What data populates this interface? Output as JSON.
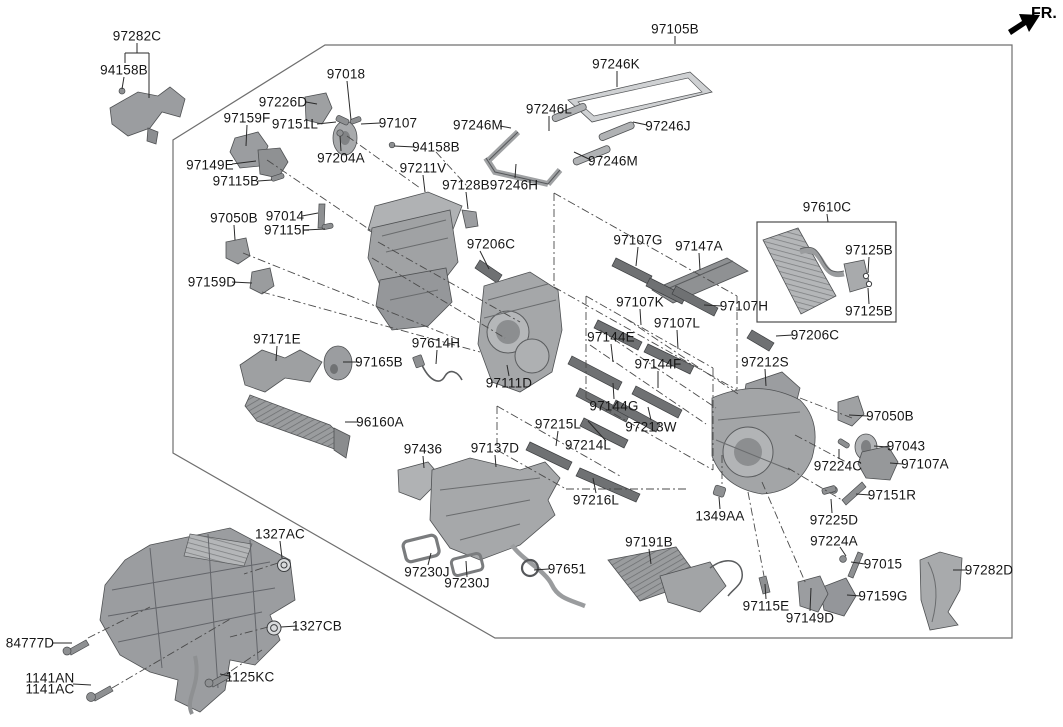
{
  "fr_indicator": {
    "label": "FR."
  },
  "canvas": {
    "width": 1063,
    "height": 727,
    "background": "#ffffff"
  },
  "styles": {
    "label_color": "#161616",
    "line_color": "#2a2a2a",
    "border_color": "#6f6f6f",
    "part_fill": "#a7a9ab",
    "part_fill_dark": "#7d8082",
    "part_fill_light": "#c9cbcd"
  },
  "labels": [
    {
      "t": "97282C",
      "x": 137,
      "y": 36,
      "l": null
    },
    {
      "t": "94158B",
      "x": 124,
      "y": 70,
      "l": [
        124,
        77,
        122,
        89
      ]
    },
    {
      "t": "97226D",
      "x": 283,
      "y": 102,
      "l": [
        306,
        102,
        317,
        104
      ]
    },
    {
      "t": "97018",
      "x": 346,
      "y": 74,
      "l": [
        347,
        81,
        351,
        120
      ]
    },
    {
      "t": "97159F",
      "x": 247,
      "y": 118,
      "l": [
        247,
        125,
        246,
        146
      ]
    },
    {
      "t": "97151L",
      "x": 295,
      "y": 124,
      "l": [
        317,
        124,
        336,
        122
      ]
    },
    {
      "t": "97107",
      "x": 398,
      "y": 123,
      "l": [
        380,
        123,
        361,
        124
      ]
    },
    {
      "t": "97204A",
      "x": 341,
      "y": 158,
      "l": [
        341,
        151,
        340,
        136
      ]
    },
    {
      "t": "94158B",
      "x": 436,
      "y": 147,
      "l": [
        415,
        147,
        394,
        146
      ]
    },
    {
      "t": "97149E",
      "x": 210,
      "y": 165,
      "l": [
        232,
        164,
        256,
        161
      ]
    },
    {
      "t": "97115B",
      "x": 236,
      "y": 181,
      "l": [
        258,
        181,
        272,
        180
      ]
    },
    {
      "t": "97211V",
      "x": 423,
      "y": 168,
      "l": [
        423,
        175,
        425,
        192
      ]
    },
    {
      "t": "97128B",
      "x": 466,
      "y": 185,
      "l": [
        466,
        192,
        468,
        209
      ]
    },
    {
      "t": "97246H",
      "x": 514,
      "y": 185,
      "l": [
        515,
        178,
        516,
        164
      ]
    },
    {
      "t": "97246M",
      "x": 478,
      "y": 125,
      "l": [
        500,
        126,
        511,
        128
      ]
    },
    {
      "t": "97246L",
      "x": 549,
      "y": 109,
      "l": [
        549,
        116,
        549,
        131
      ]
    },
    {
      "t": "97246K",
      "x": 616,
      "y": 64,
      "l": [
        617,
        71,
        617,
        87
      ]
    },
    {
      "t": "97246J",
      "x": 668,
      "y": 126,
      "l": [
        647,
        125,
        633,
        122
      ]
    },
    {
      "t": "97246M",
      "x": 613,
      "y": 161,
      "l": [
        591,
        160,
        574,
        152
      ]
    },
    {
      "t": "97105B",
      "x": 675,
      "y": 29,
      "l": [
        675,
        36,
        675,
        44
      ]
    },
    {
      "t": "97610C",
      "x": 827,
      "y": 207,
      "l": [
        827,
        214,
        828,
        222
      ]
    },
    {
      "t": "97125B",
      "x": 869,
      "y": 250,
      "l": [
        869,
        257,
        868,
        273
      ]
    },
    {
      "t": "97125B",
      "x": 869,
      "y": 311,
      "l": [
        869,
        304,
        868,
        288
      ]
    },
    {
      "t": "97206C",
      "x": 815,
      "y": 335,
      "l": [
        793,
        335,
        776,
        336
      ]
    },
    {
      "t": "97107H",
      "x": 744,
      "y": 306,
      "l": [
        722,
        306,
        704,
        305
      ]
    },
    {
      "t": "97107G",
      "x": 638,
      "y": 240,
      "l": [
        638,
        247,
        636,
        266
      ]
    },
    {
      "t": "97147A",
      "x": 699,
      "y": 246,
      "l": [
        699,
        253,
        700,
        270
      ]
    },
    {
      "t": "97107K",
      "x": 640,
      "y": 302,
      "l": [
        640,
        309,
        641,
        325
      ]
    },
    {
      "t": "97107L",
      "x": 677,
      "y": 323,
      "l": [
        677,
        330,
        678,
        349
      ]
    },
    {
      "t": "97144E",
      "x": 611,
      "y": 337,
      "l": [
        611,
        344,
        613,
        362
      ]
    },
    {
      "t": "97206C",
      "x": 491,
      "y": 244,
      "l": [
        480,
        251,
        489,
        269
      ]
    },
    {
      "t": "97212S",
      "x": 765,
      "y": 362,
      "l": [
        765,
        369,
        766,
        386
      ]
    },
    {
      "t": "97144F",
      "x": 658,
      "y": 364,
      "l": [
        658,
        371,
        658,
        388
      ]
    },
    {
      "t": "97144G",
      "x": 614,
      "y": 406,
      "l": [
        614,
        399,
        613,
        383
      ]
    },
    {
      "t": "97213W",
      "x": 651,
      "y": 427,
      "l": [
        651,
        420,
        648,
        407
      ]
    },
    {
      "t": "97215L",
      "x": 558,
      "y": 424,
      "l": [
        558,
        431,
        556,
        446
      ]
    },
    {
      "t": "97214L",
      "x": 588,
      "y": 445,
      "l": [
        606,
        441,
        588,
        421
      ]
    },
    {
      "t": "97216L",
      "x": 596,
      "y": 500,
      "l": [
        596,
        493,
        593,
        478
      ]
    },
    {
      "t": "1349AA",
      "x": 720,
      "y": 516,
      "l": [
        720,
        509,
        719,
        497
      ]
    },
    {
      "t": "97191B",
      "x": 649,
      "y": 542,
      "l": [
        649,
        549,
        651,
        564
      ]
    },
    {
      "t": "97436",
      "x": 423,
      "y": 449,
      "l": [
        423,
        456,
        424,
        468
      ]
    },
    {
      "t": "97137D",
      "x": 495,
      "y": 448,
      "l": [
        495,
        455,
        496,
        467
      ]
    },
    {
      "t": "97050B",
      "x": 234,
      "y": 218,
      "l": [
        234,
        225,
        235,
        240
      ]
    },
    {
      "t": "97014",
      "x": 285,
      "y": 216,
      "l": [
        302,
        216,
        318,
        213
      ]
    },
    {
      "t": "97115F",
      "x": 287,
      "y": 230,
      "l": [
        305,
        230,
        325,
        229
      ]
    },
    {
      "t": "97159D",
      "x": 212,
      "y": 282,
      "l": [
        232,
        282,
        252,
        283
      ]
    },
    {
      "t": "97171E",
      "x": 277,
      "y": 339,
      "l": [
        277,
        346,
        276,
        361
      ]
    },
    {
      "t": "97165B",
      "x": 379,
      "y": 362,
      "l": [
        359,
        362,
        343,
        362
      ]
    },
    {
      "t": "97614H",
      "x": 436,
      "y": 343,
      "l": [
        437,
        350,
        436,
        364
      ]
    },
    {
      "t": "97111D",
      "x": 509,
      "y": 383,
      "l": [
        509,
        376,
        507,
        365
      ]
    },
    {
      "t": "96160A",
      "x": 380,
      "y": 422,
      "l": [
        358,
        422,
        345,
        422
      ]
    },
    {
      "t": "97050B",
      "x": 890,
      "y": 416,
      "l": [
        868,
        416,
        849,
        415
      ]
    },
    {
      "t": "97043",
      "x": 906,
      "y": 446,
      "l": [
        888,
        447,
        874,
        446
      ]
    },
    {
      "t": "97224C",
      "x": 838,
      "y": 466,
      "l": [
        839,
        459,
        839,
        449
      ]
    },
    {
      "t": "97107A",
      "x": 925,
      "y": 464,
      "l": [
        903,
        464,
        890,
        463
      ]
    },
    {
      "t": "97151R",
      "x": 892,
      "y": 495,
      "l": [
        870,
        495,
        856,
        494
      ]
    },
    {
      "t": "97225D",
      "x": 834,
      "y": 520,
      "l": [
        832,
        513,
        831,
        499
      ]
    },
    {
      "t": "97224A",
      "x": 834,
      "y": 541,
      "l": [
        840,
        547,
        846,
        556
      ]
    },
    {
      "t": "97015",
      "x": 883,
      "y": 564,
      "l": [
        865,
        564,
        851,
        562
      ]
    },
    {
      "t": "97282D",
      "x": 989,
      "y": 570,
      "l": [
        967,
        570,
        953,
        570
      ]
    },
    {
      "t": "97159G",
      "x": 883,
      "y": 596,
      "l": [
        861,
        596,
        847,
        595
      ]
    },
    {
      "t": "97115E",
      "x": 766,
      "y": 606,
      "l": [
        766,
        599,
        765,
        584
      ]
    },
    {
      "t": "97149D",
      "x": 810,
      "y": 618,
      "l": [
        810,
        611,
        811,
        588
      ]
    },
    {
      "t": "1327AC",
      "x": 280,
      "y": 534,
      "l": [
        280,
        541,
        282,
        558
      ]
    },
    {
      "t": "1327CB",
      "x": 317,
      "y": 626,
      "l": [
        297,
        626,
        281,
        627
      ]
    },
    {
      "t": "84777D",
      "x": 30,
      "y": 643,
      "l": [
        53,
        643,
        72,
        643
      ]
    },
    {
      "t": "1141AN",
      "x": 50,
      "y": 678,
      "l": null
    },
    {
      "t": "1141AC",
      "x": 50,
      "y": 689,
      "l": null
    },
    {
      "t": "1125KC",
      "x": 250,
      "y": 677,
      "l": [
        229,
        676,
        220,
        674
      ]
    },
    {
      "t": "97230J",
      "x": 427,
      "y": 572,
      "l": [
        428,
        565,
        431,
        553
      ]
    },
    {
      "t": "97230J",
      "x": 467,
      "y": 583,
      "l": [
        467,
        577,
        466,
        561
      ]
    },
    {
      "t": "97651",
      "x": 567,
      "y": 569,
      "l": [
        549,
        569,
        534,
        570
      ]
    }
  ],
  "solid_segments": [
    [
      137,
      43,
      137,
      53
    ],
    [
      125,
      53,
      149,
      53
    ],
    [
      125,
      53,
      125,
      63
    ],
    [
      149,
      53,
      149,
      98
    ],
    [
      73,
      684,
      91,
      685
    ]
  ],
  "dash_segments": [
    [
      554,
      193,
      737,
      296
    ],
    [
      554,
      193,
      554,
      287
    ],
    [
      554,
      287,
      737,
      390
    ],
    [
      737,
      296,
      737,
      390
    ],
    [
      586,
      296,
      713,
      368
    ],
    [
      586,
      296,
      586,
      398
    ],
    [
      586,
      398,
      713,
      470
    ],
    [
      713,
      368,
      713,
      470
    ],
    [
      347,
      136,
      420,
      188
    ],
    [
      267,
      160,
      373,
      232
    ],
    [
      243,
      253,
      460,
      340
    ],
    [
      262,
      292,
      480,
      352
    ],
    [
      436,
      152,
      467,
      186
    ],
    [
      378,
      242,
      520,
      322
    ],
    [
      372,
      258,
      505,
      338
    ],
    [
      600,
      330,
      716,
      408
    ],
    [
      590,
      345,
      706,
      424
    ],
    [
      625,
      318,
      738,
      394
    ],
    [
      800,
      398,
      852,
      418
    ],
    [
      795,
      435,
      846,
      462
    ],
    [
      788,
      468,
      842,
      500
    ],
    [
      762,
      482,
      806,
      584
    ],
    [
      748,
      492,
      764,
      576
    ],
    [
      88,
      638,
      150,
      607
    ],
    [
      112,
      688,
      232,
      618
    ],
    [
      231,
      671,
      262,
      650
    ],
    [
      278,
      563,
      244,
      574
    ],
    [
      268,
      627,
      230,
      637
    ],
    [
      497,
      406,
      497,
      450
    ],
    [
      497,
      406,
      620,
      476
    ],
    [
      497,
      450,
      566,
      489
    ],
    [
      566,
      489,
      688,
      489
    ],
    [
      722,
      455,
      722,
      485
    ]
  ],
  "border_polygon": "325,45 1012,45 1012,638 495,638 173,453 173,140",
  "ref_box": {
    "x": 757,
    "y": 222,
    "w": 139,
    "h": 100
  }
}
